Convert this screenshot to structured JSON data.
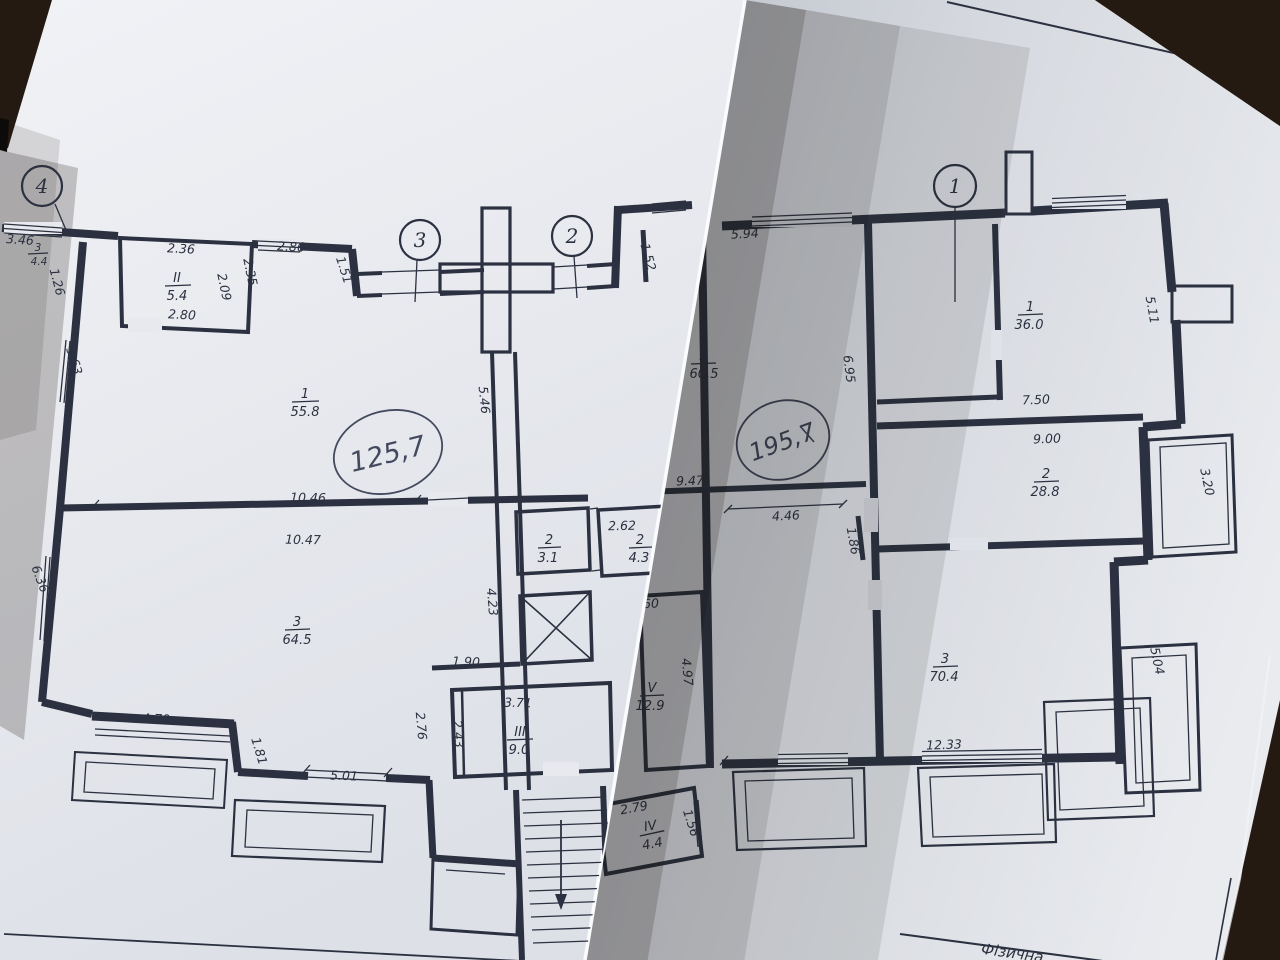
{
  "photo": {
    "description": "Two overlapping paper floor-plan sheets photographed on a dark table",
    "colors": {
      "background": "#241a11",
      "paper_left": "#e9ebef",
      "paper_right": "#d7dae0",
      "ink": "#2b3140"
    }
  },
  "left_sheet": {
    "axis_markers": [
      "4",
      "3",
      "2"
    ],
    "dims": [
      "3.46",
      "1.26",
      "2.36",
      "2.09",
      "2.35",
      "2.80",
      "2.86",
      "1.51",
      "1.52",
      "3.63",
      "5.46",
      "6.36",
      "10.46",
      "10.47",
      "4.23",
      "1.90",
      "2.76",
      "2.43",
      "3.71",
      "5.01",
      "1.81",
      "4.70",
      "2.62",
      "1.65"
    ],
    "rooms": [
      {
        "n": "3",
        "a": "4.4"
      },
      {
        "n": "II",
        "a": "5.4"
      },
      {
        "n": "1",
        "a": "55.8"
      },
      {
        "n": "3",
        "a": "64.5"
      },
      {
        "n": "2",
        "a": "3.1"
      },
      {
        "n": "2",
        "a": "4.3"
      },
      {
        "n": "III",
        "a": "9.0"
      }
    ],
    "handwritten_total": "125,7"
  },
  "right_sheet": {
    "axis_markers": [
      "1"
    ],
    "dims": [
      "5.94",
      "6.95",
      "9.47",
      "4.46",
      "1.86",
      "2.60",
      "4.97",
      "5.11",
      "7.50",
      "9.00",
      "3.20",
      "12.33",
      "5.04",
      "2.79",
      "1.56"
    ],
    "rooms": [
      {
        "n": "1",
        "a": "60.5"
      },
      {
        "n": "1",
        "a": "36.0"
      },
      {
        "n": "2",
        "a": "28.8"
      },
      {
        "n": "3",
        "a": "70.4"
      },
      {
        "n": "V",
        "a": "12.9"
      },
      {
        "n": "IV",
        "a": "4.4"
      }
    ],
    "handwritten_total": "195,7",
    "title_block_text": "Фізична"
  }
}
